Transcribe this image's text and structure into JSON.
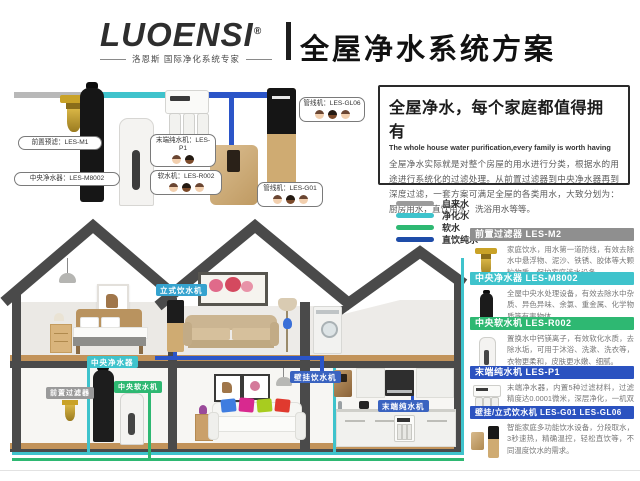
{
  "header": {
    "logo": "LUOENSI",
    "reg": "®",
    "tagline": "洛恩斯 国际净化系统专家",
    "title": "全屋净水系统方案"
  },
  "intro": {
    "title": "全屋净水，每个家庭都值得拥有",
    "subtitle": "The whole house water purification,every family is worth having",
    "body": "全屋净水实际就是对整个房屋的用水进行分类，根据水的用途进行系统化的过滤处理。从前置过滤器到中央净水器再到深度过滤，一套方案可满足全屋的各类用水，大致分划为：厨房用水，直饮用水，洗浴用水等等。"
  },
  "legend": {
    "items": [
      {
        "label": "自来水",
        "color": "#9b9b9b"
      },
      {
        "label": "净化水",
        "color": "#3fc3cc"
      },
      {
        "label": "软水",
        "color": "#2eb872"
      },
      {
        "label": "直饮纯水",
        "color": "#1e4ca8"
      }
    ]
  },
  "diagram": {
    "labels": {
      "pre_filter": "前置预滤：LES-M1",
      "central_purifier": "中央净水器：LES-M8002",
      "end_purifier": "末端纯水机：LES-P1",
      "softener": "软水机：LES-R002",
      "pipeline_top": "管线机：LES-GL06",
      "pipeline_bottom": "管线机：LES-G01"
    }
  },
  "products": [
    {
      "name": "前置过滤器 LES-M2",
      "color": "#8f8f8f",
      "desc": "家庭饮水，用水第一道防线，有效去除水中悬浮物、泥沙、铁锈、胶体等大颗粒物质，保护家庭涉水设备。"
    },
    {
      "name": "中央净水器 LES-M8002",
      "color": "#3fc3cc",
      "desc": "全屋中央水处理设备，有效去除水中杂质、异色异味、余氯、重金属、化学物质等有害物体。"
    },
    {
      "name": "中央软水机 LES-R002",
      "color": "#2eb872",
      "desc": "置换水中钙镁离子，有效软化水质，去除水垢，可用于沐浴、洗漱、洗衣等，衣物更柔和，皮肤更水嫩、细腻。"
    },
    {
      "name": "末端纯水机 LES-P1",
      "color": "#2b52c0",
      "desc": "末端净水器，内置5种过滤材料，过滤精度达0.0001微米，深层净化，一机双水，满足厨房用水跟直饮水。"
    },
    {
      "name": "壁挂/立式饮水机 LES-G01 LES-GL06",
      "color": "#2b52c0",
      "desc": "智能家庭多功能饮水设备，分段取水，3秒速热，精确温控，轻松直饮等，不同温度饮水的需求。"
    }
  ],
  "house": {
    "badges": [
      {
        "label": "中央净水器",
        "color": "#3fc3cc"
      },
      {
        "label": "前置过滤器",
        "color": "#9a9a9a"
      },
      {
        "label": "中央软水机",
        "color": "#2eb872"
      },
      {
        "label": "立式饮水机",
        "color": "#35a3cf"
      },
      {
        "label": "壁挂饮水机",
        "color": "#3a63c0"
      },
      {
        "label": "末端纯水机",
        "color": "#3a63c0"
      }
    ]
  }
}
